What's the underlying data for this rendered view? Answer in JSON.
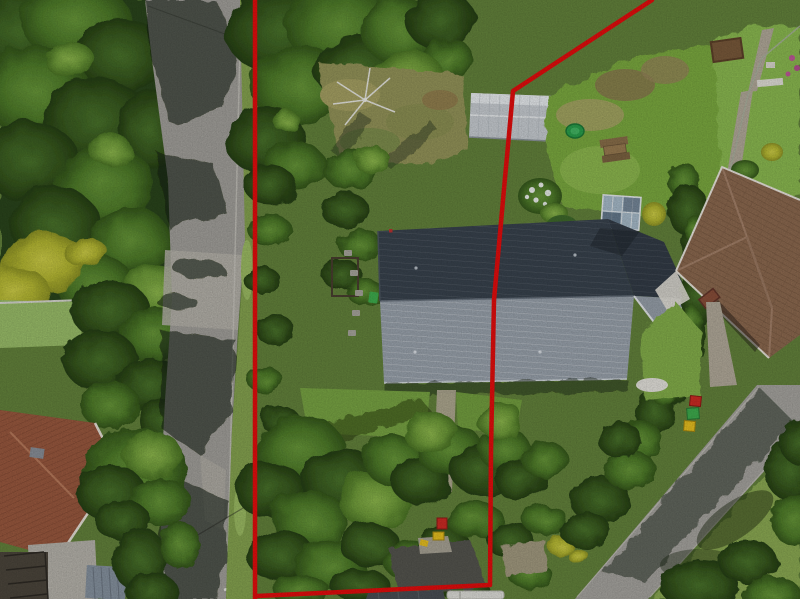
{
  "meta": {
    "title": "Aerial drone photo of a property with red boundary outline",
    "type": "real-estate aerial photograph",
    "description": "Top-down drone view: a vertical country road flanked by dense trees on the left, a long section of land outlined in red containing a large grey metal-roofed house, a light grey garden shed, a greenhouse, lawns and overgrown shrubs; neighbouring tiled-roof houses at lower-left and right, and a second street at lower-right."
  },
  "palette": {
    "boundary_red": "#e60d0d",
    "grass_base": "#64833c",
    "lawn_bright": "#7cab3f",
    "neighbour_lawn": "#8cbb51",
    "forest_dark": "#2a451b",
    "road": "#a3a19c",
    "street_right": "#a7a5a0",
    "main_roof_dark": "#39434e",
    "main_roof_light": "#9aa3ad",
    "extension_roof": "#333c47",
    "shed_roof": "#c9ced3",
    "right_house_roof": "#8d6a50",
    "left_house_roof": "#9a593f",
    "greenhouse_glass": "#a8bccb",
    "asphalt_patch": "#55554f",
    "pool_green": "#2aa04c",
    "bin_red": "#cf2b24",
    "bin_green": "#3fae4e",
    "bin_yellow": "#e8c020",
    "deck_wood": "#4c463c",
    "blue_shed": "#8793a0",
    "patio_concrete": "#b7b4ac"
  },
  "boundary": {
    "main_points": "652,0 513,91 505,178 494,300 491,450 490,585 257,596",
    "left_line_points": "255,0 255,599",
    "stroke_width": "4.5"
  },
  "scene": {
    "objects": [
      "left country road with tree shadows",
      "red legal boundary overlay",
      "main house long grey corrugated metal roof",
      "rear extension roof and light gable",
      "light grey garden shed crossed by boundary",
      "glass greenhouse",
      "wooden picnic table",
      "green paddling pool",
      "collapsed rotary clothesline",
      "white flowering shrub",
      "concrete path below house",
      "dark asphalt parking patch",
      "red / yellow wheelie bins by driveway",
      "red / green / yellow bins beside neighbour hedge",
      "neighbour house with brown tiled hip roof",
      "neighbour house with terracotta roof, deck and blue shed",
      "second street at lower right",
      "dense conifer belt on the west side",
      "yellow flowering broom shrubs",
      "wire garden fence on the east side",
      "white vehicle at bottom gateway"
    ]
  }
}
